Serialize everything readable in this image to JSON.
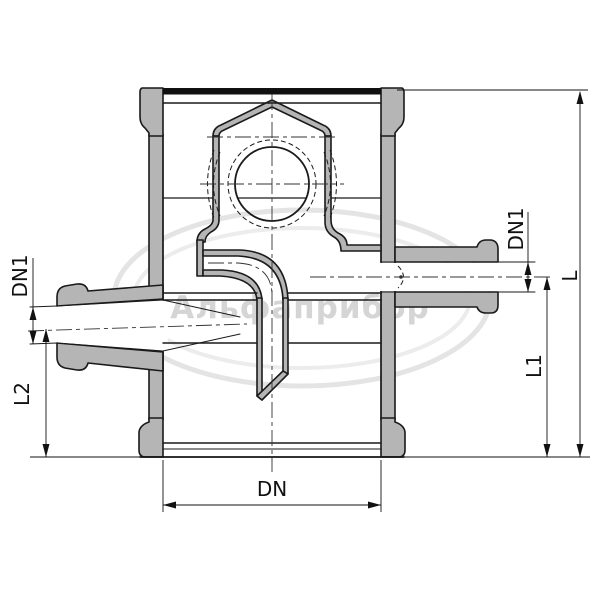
{
  "drawing": {
    "kind": "sectional technical drawing of valve body with side nozzles",
    "watermark": {
      "text": "Альфаприбор"
    },
    "labels": {
      "dn1_left": "DN1",
      "l2": "L2",
      "dn": "DN",
      "dn1_right": "DN1",
      "l1": "L1",
      "l": "L"
    },
    "colors": {
      "background": "#ffffff",
      "section_fill": "#b5b5b5",
      "outline": "#1a1a1a",
      "centerline": "#333333",
      "watermark_ring": "#e4e4e4",
      "watermark_text": "#d5d5d5"
    }
  }
}
